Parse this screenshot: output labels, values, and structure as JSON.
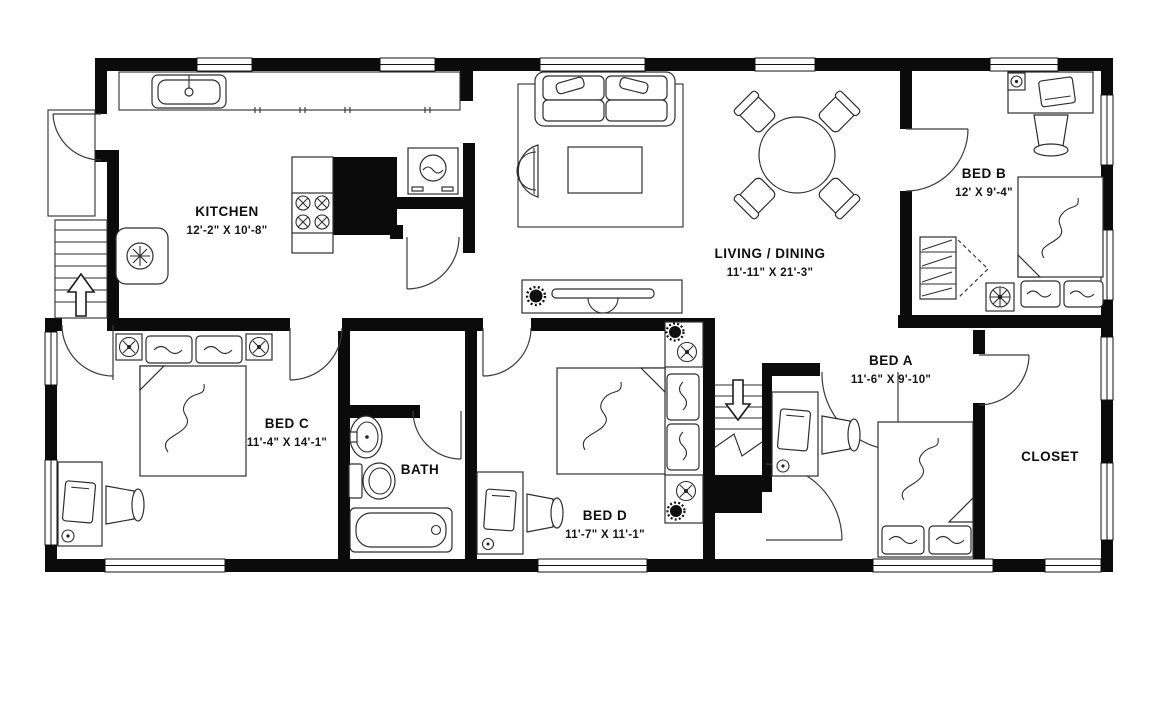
{
  "title": "3-4 bedroom apartment floor plan",
  "colors": {
    "wall": "#0b0b0b",
    "line": "#2e2e2e",
    "background": "#ffffff"
  },
  "rooms": [
    {
      "id": "kitchen",
      "name": "KITCHEN",
      "dims": "12'-2\" X 10'-8\""
    },
    {
      "id": "living-dining",
      "name": "LIVING / DINING",
      "dims": "11'-11\" X 21'-3\""
    },
    {
      "id": "bed-b",
      "name": "BED B",
      "dims": "12' X 9'-4\""
    },
    {
      "id": "bed-a",
      "name": "BED A",
      "dims": "11'-6\" X 9'-10\""
    },
    {
      "id": "bed-c",
      "name": "BED C",
      "dims": "11'-4\" X 14'-1\""
    },
    {
      "id": "bed-d",
      "name": "BED D",
      "dims": "11'-7\" X 11'-1\""
    },
    {
      "id": "bath",
      "name": "BATH",
      "dims": ""
    },
    {
      "id": "closet",
      "name": "CLOSET",
      "dims": ""
    }
  ],
  "icons": {
    "stairs_up_arrow": "up",
    "stairs_down_arrow": "down",
    "fixtures": [
      "kitchen-sink",
      "stove",
      "washer",
      "refrigerator",
      "ceiling-fan",
      "plant",
      "sofa",
      "armchair",
      "coffee-table",
      "rug",
      "tv-console",
      "dining-table",
      "dining-chair",
      "bed",
      "pillow",
      "desk",
      "desk-chair",
      "laptop",
      "wardrobe-shelves",
      "bathroom-sink",
      "toilet",
      "bathtub"
    ]
  }
}
